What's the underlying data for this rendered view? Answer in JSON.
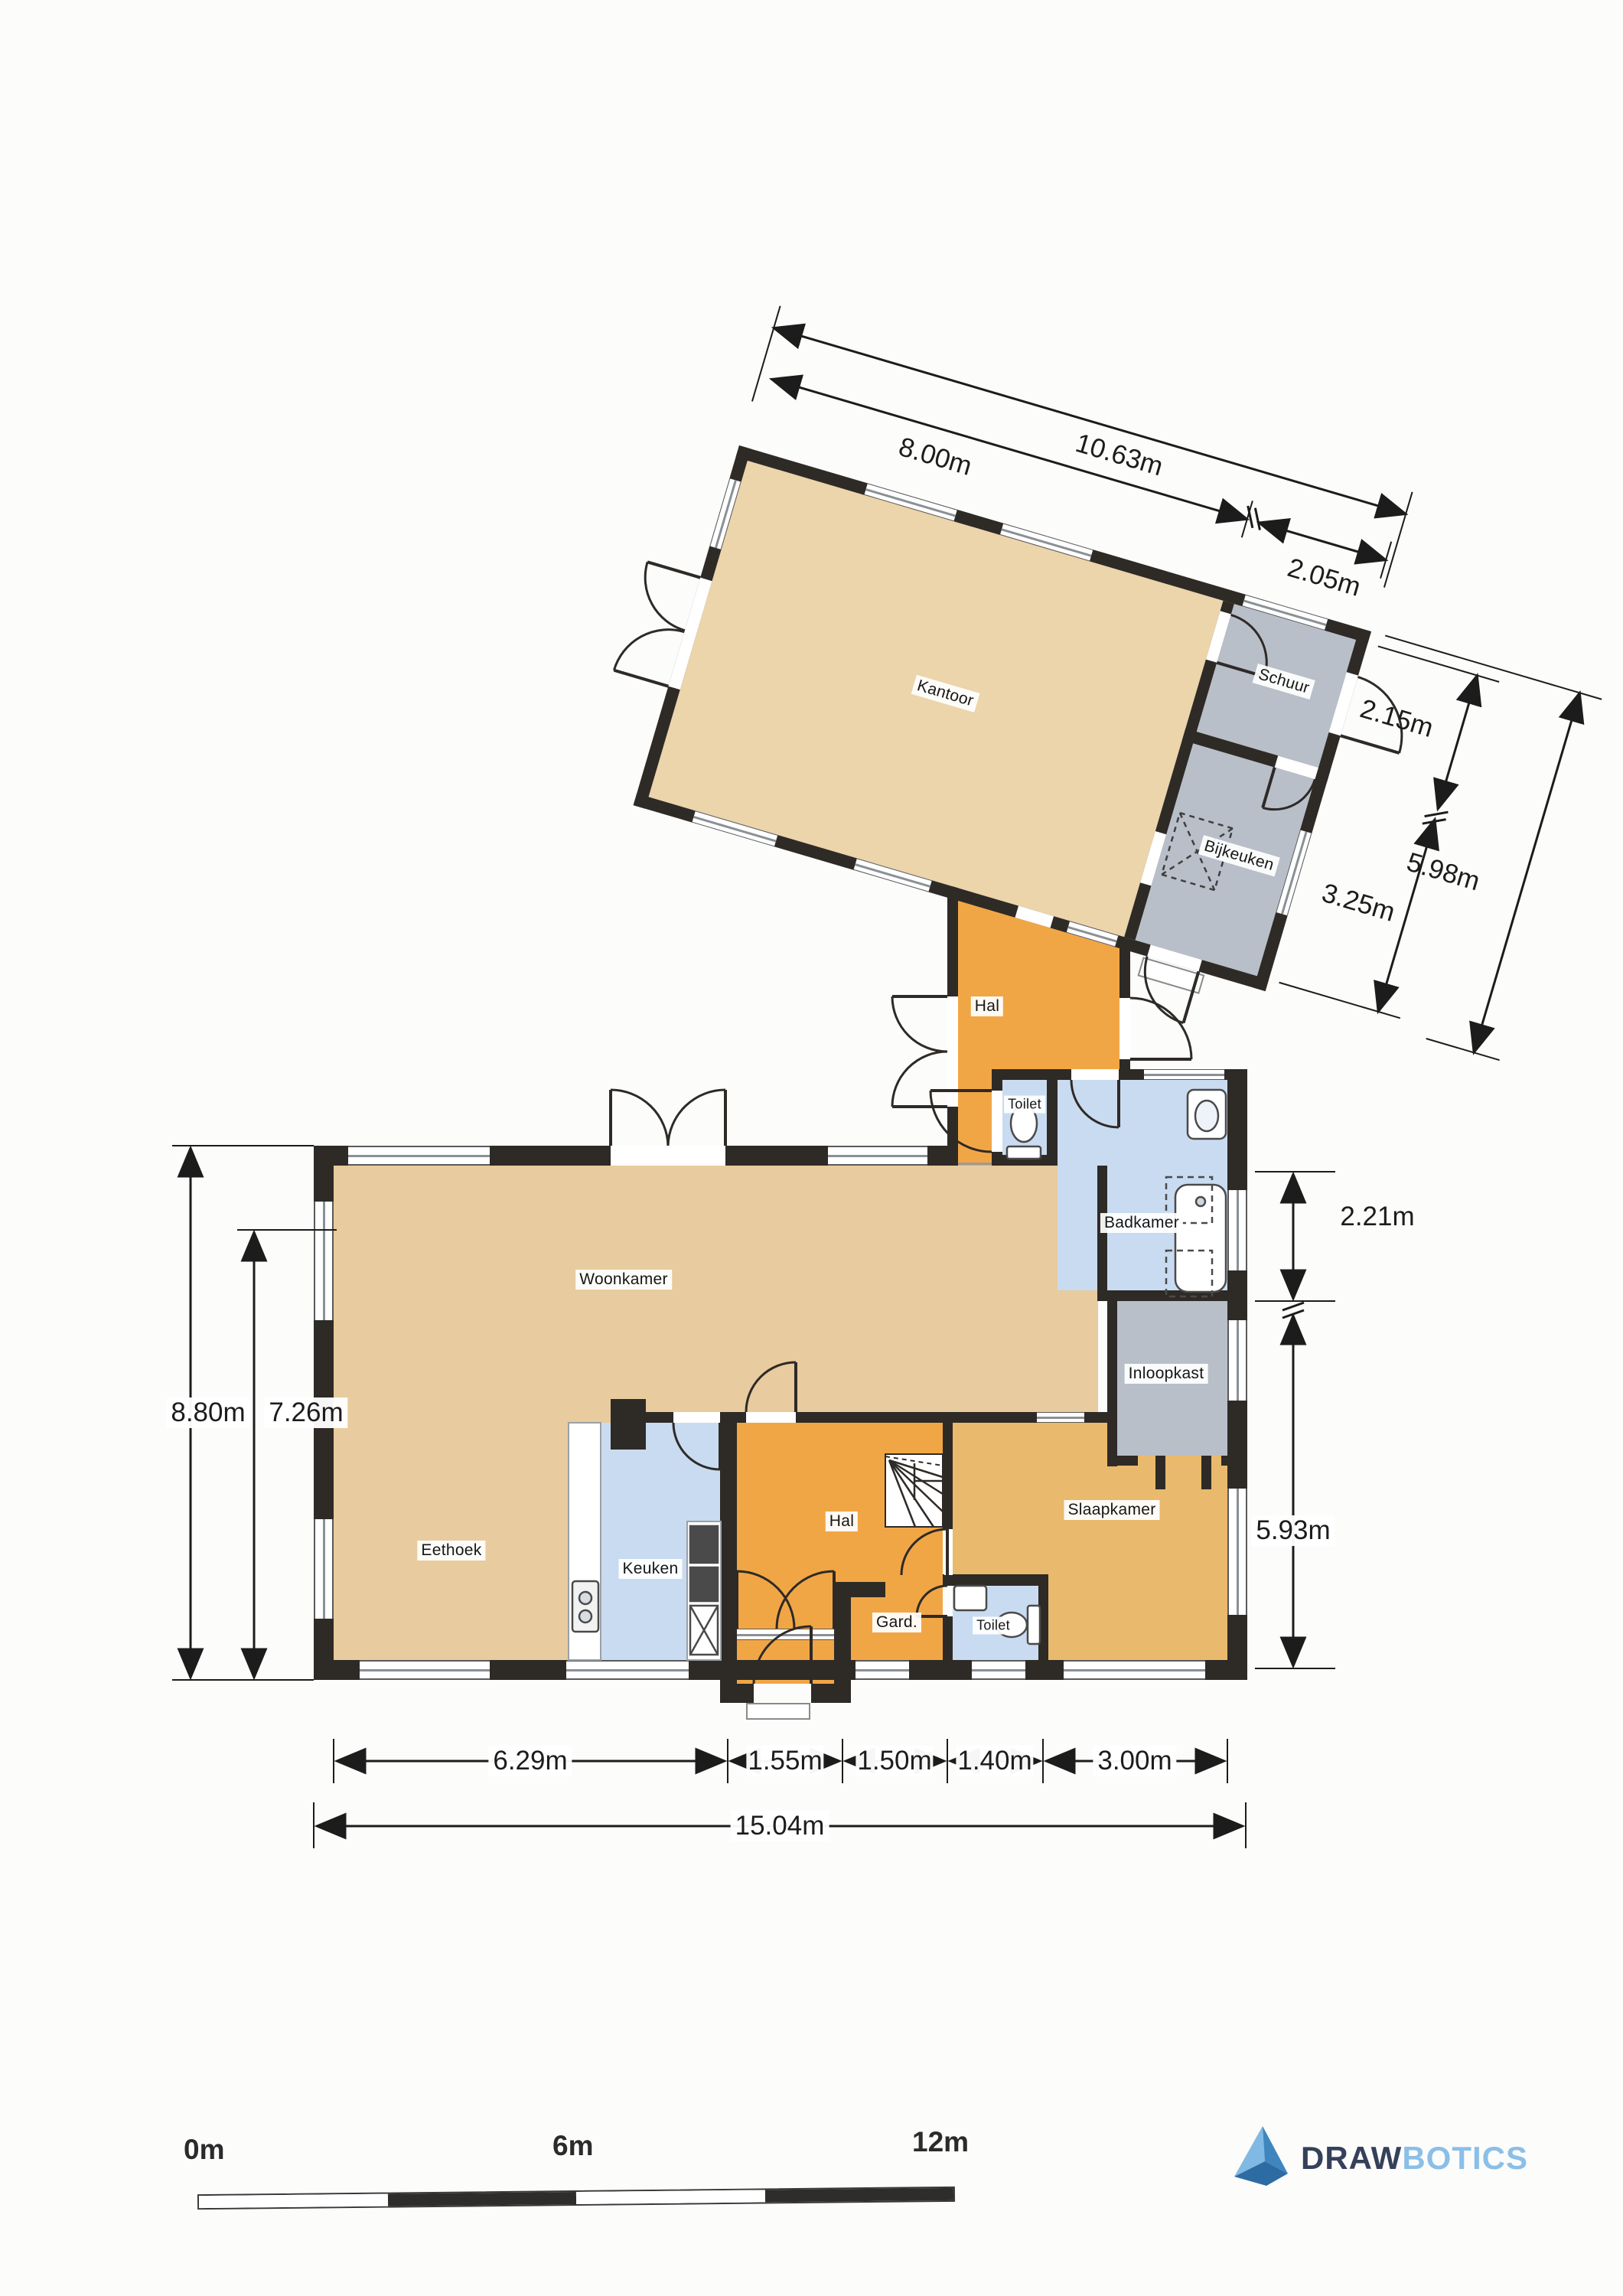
{
  "rooms": {
    "kantoor": "Kantoor",
    "schuur": "Schuur",
    "bijkeuken": "Bijkeuken",
    "hal_boven": "Hal",
    "toilet_boven": "Toilet",
    "badkamer": "Badkamer",
    "woonkamer": "Woonkamer",
    "inloopkast": "Inloopkast",
    "eethoek": "Eethoek",
    "keuken": "Keuken",
    "hal_beneden": "Hal",
    "gard": "Gard.",
    "toilet_beneden": "Toilet",
    "slaapkamer": "Slaapkamer"
  },
  "dimensions": {
    "top_total": "10.63m",
    "top_kantoor": "8.00m",
    "top_schuur": "2.05m",
    "right_schuur": "2.15m",
    "right_total": "5.98m",
    "right_bijkeuken": "3.25m",
    "right_badkamer": "2.21m",
    "right_slaapkamer": "5.93m",
    "left_outer": "8.80m",
    "left_inner": "7.26m",
    "bottom_eethoek": "6.29m",
    "bottom_hal": "1.55m",
    "bottom_gard": "1.50m",
    "bottom_toilet": "1.40m",
    "bottom_slaapkamer": "3.00m",
    "bottom_total": "15.04m"
  },
  "scale_bar": {
    "start": "0m",
    "middle": "6m",
    "end": "12m"
  },
  "logo": {
    "brand_primary": "DRAW",
    "brand_secondary": "BOTICS",
    "triangle_icon": "drawbotics-pyramid-icon"
  },
  "colors": {
    "wall": "#2e2a26",
    "tan": "#e8cb9e",
    "tan_light": "#ecd4ab",
    "ochre": "#e9b96d",
    "orange": "#f1a645",
    "gray": "#b8bfc9",
    "blue": "#c9dbf0",
    "dim": "#1c1c1c",
    "label": "#161616",
    "window_line": "#8a9096",
    "scalebar_dark": "#2f2d2b",
    "logo_dark": "#35415a",
    "logo_blue": "#8abfe8",
    "logo_tri_light": "#7fb9e4",
    "logo_tri_mid": "#3f86be",
    "logo_tri_dark": "#2d6ca3"
  }
}
